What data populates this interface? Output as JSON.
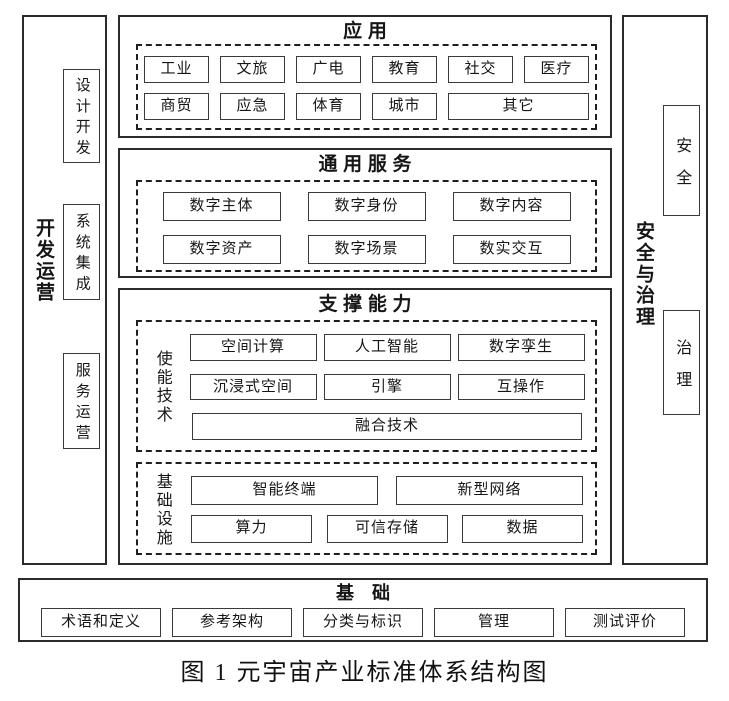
{
  "colors": {
    "ink": "#1d1d1d",
    "background": "#ffffff"
  },
  "left_bar": {
    "label": "开发运营",
    "items": [
      "设计开发",
      "系统集成",
      "服务运营"
    ]
  },
  "right_bar": {
    "label": "安全与治理",
    "items": [
      "安全",
      "治理"
    ]
  },
  "application": {
    "title": "应用",
    "row1": [
      "工业",
      "文旅",
      "广电",
      "教育",
      "社交",
      "医疗"
    ],
    "row2": [
      "商贸",
      "应急",
      "体育",
      "城市",
      "其它"
    ]
  },
  "services": {
    "title": "通用服务",
    "row1": [
      "数字主体",
      "数字身份",
      "数字内容"
    ],
    "row2": [
      "数字资产",
      "数字场景",
      "数实交互"
    ]
  },
  "support": {
    "title": "支撑能力",
    "enabling": {
      "label": "使能技术",
      "row1": [
        "空间计算",
        "人工智能",
        "数字孪生"
      ],
      "row2": [
        "沉浸式空间",
        "引擎",
        "互操作"
      ],
      "row3": "融合技术"
    },
    "infrastructure": {
      "label": "基础设施",
      "row1": [
        "智能终端",
        "新型网络"
      ],
      "row2": [
        "算力",
        "可信存储",
        "数据"
      ]
    }
  },
  "foundation": {
    "title": "基础",
    "items": [
      "术语和定义",
      "参考架构",
      "分类与标识",
      "管理",
      "测试评价"
    ]
  },
  "caption": "图 1 元宇宙产业标准体系结构图"
}
